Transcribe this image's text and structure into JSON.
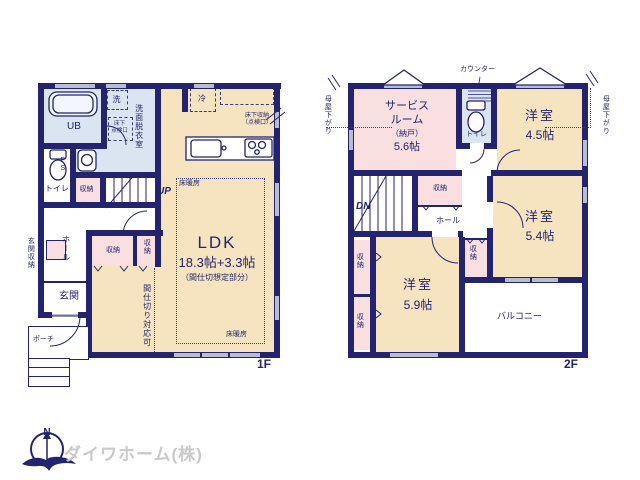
{
  "floor1": {
    "label": "1F",
    "ub": "UB",
    "washroom": "洗面脱衣室",
    "laundry": "洗",
    "underfloor_hatch": "床下\n点検口",
    "fridge": "冷",
    "underfloor_storage": "床下収納\n（点検口）",
    "toilet": "トイレ",
    "ps": "PS",
    "storage": "収納",
    "up": "UP",
    "floor_heating": "床暖房",
    "hall": "ホール",
    "entrance_storage": "玄関収納",
    "entrance": "玄関",
    "porch": "ポーチ",
    "partitionable": "間仕切り対応可",
    "ldk": "LDK",
    "ldk_size": "18.3帖+3.3帖",
    "ldk_note": "（間仕切想定部分）"
  },
  "floor2": {
    "label": "2F",
    "counter": "カウンター",
    "service_room_line1": "サービス",
    "service_room_line2": "ルーム",
    "service_room_line3": "（納戸）",
    "service_room_size": "5.6帖",
    "toilet": "トイレ",
    "western_room": "洋室",
    "room45_size": "4.5帖",
    "room54_size": "5.4帖",
    "room59_size": "5.9帖",
    "dn": "DN",
    "storage": "収納",
    "hall": "ホール",
    "balcony": "バルコニー",
    "eaves_note": "母屋下がり"
  },
  "logo": {
    "company": "ダイワホーム(株)",
    "north": "N"
  },
  "colors": {
    "wall_navy": "#23236f",
    "tatami_cream": "#f6e4c0",
    "closet_pink": "#f9dfe0",
    "wet_area_blue": "#dbe5f2"
  }
}
